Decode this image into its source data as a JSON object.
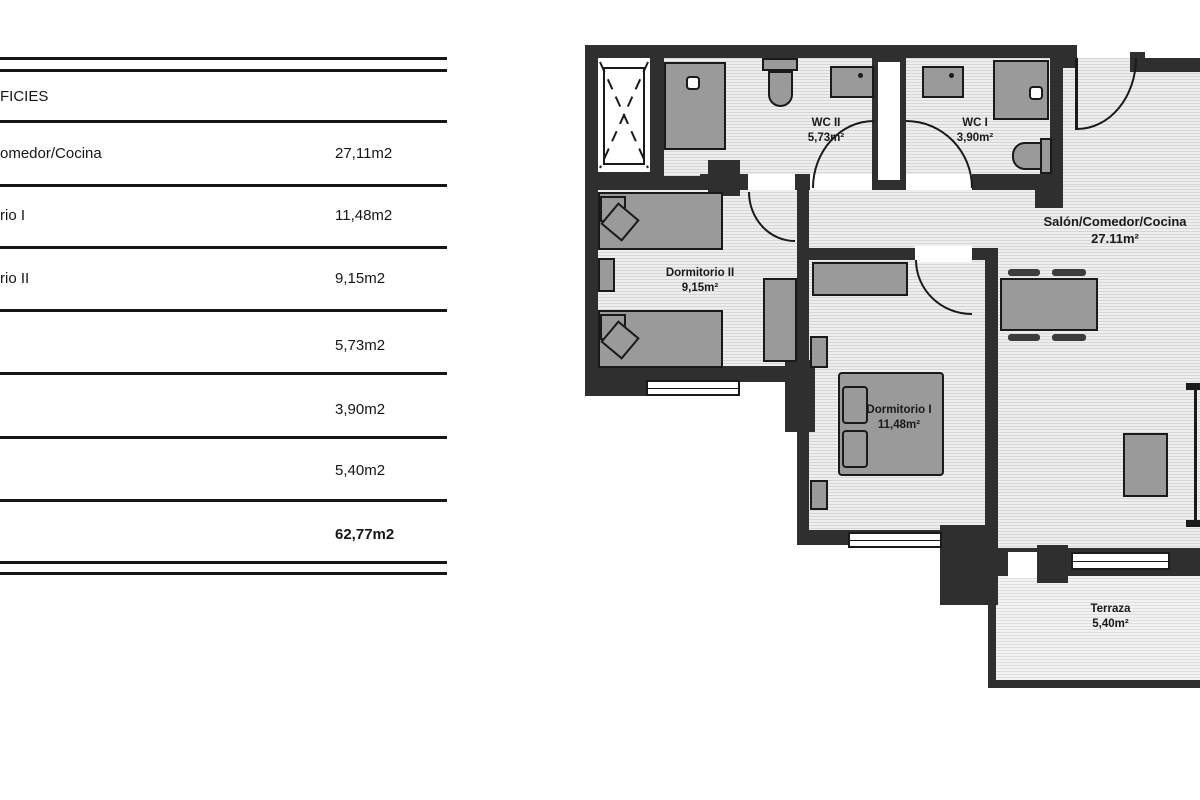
{
  "panel": {
    "header": "FICIES",
    "rows": [
      {
        "label": "omedor/Cocina",
        "value": "27,11m2"
      },
      {
        "label": "rio I",
        "value": "11,48m2"
      },
      {
        "label": "rio II",
        "value": "9,15m2"
      },
      {
        "label": "",
        "value": "5,73m2"
      },
      {
        "label": "",
        "value": "3,90m2"
      },
      {
        "label": "",
        "value": "5,40m2"
      },
      {
        "label": "",
        "value": "62,77m2"
      }
    ]
  },
  "plan": {
    "labels": {
      "wc2": {
        "name": "WC II",
        "area": "5,73m²"
      },
      "wc1": {
        "name": "WC I",
        "area": "3,90m²"
      },
      "salon": {
        "name": "Salón/Comedor/Cocina",
        "area": "27.11m²"
      },
      "dorm2": {
        "name": "Dormitorio II",
        "area": "9,15m²"
      },
      "dorm1": {
        "name": "Dormitorio I",
        "area": "11,48m²"
      },
      "terraza": {
        "name": "Terraza",
        "area": "5,40m²"
      }
    },
    "colors": {
      "wall": "#2f2f2f",
      "furn": "#9a9a9a",
      "floorbg": "#eeeeee",
      "floorline": "#d6d6d6",
      "ink": "#1a1a1a"
    }
  }
}
